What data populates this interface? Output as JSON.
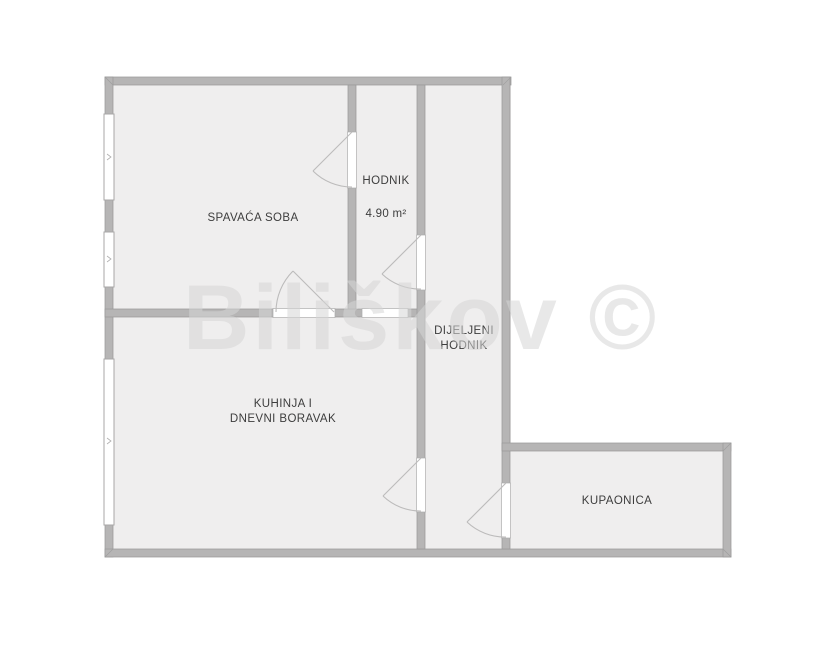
{
  "title": "Floor plan",
  "watermark": "Biliškov ©",
  "rooms": {
    "spavaca_soba": {
      "label": "SPAVAĆA SOBA"
    },
    "hodnik": {
      "label": "HODNIK",
      "area": "4.90 m²"
    },
    "dijeljeni_hodnik": {
      "label_line1": "DIJELJENI",
      "label_line2": "HODNIK"
    },
    "kuhinja_dnevni_boravak": {
      "label_line1": "KUHINJA I",
      "label_line2": "DNEVNI BORAVAK"
    },
    "kupaonica": {
      "label": "KUPAONICA"
    }
  },
  "colors": {
    "background": "#ffffff",
    "floor": "#efeeee",
    "wall": "#b6b5b5",
    "wall_edge": "#9a9a9a",
    "opening": "#ffffff",
    "door_swing": "#bcbbbb",
    "label_text": "#3d3d3d",
    "watermark": "rgba(213,213,213,0.55)"
  }
}
